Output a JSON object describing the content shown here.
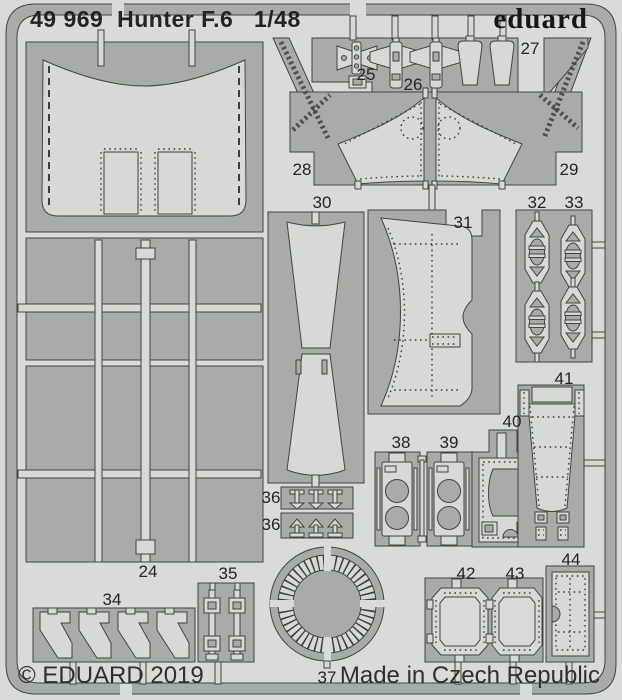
{
  "header": {
    "title": "49 969  Hunter F.6   1/48",
    "brand": "eduard"
  },
  "footer": {
    "copyright": "© EDUARD 2019",
    "made_in": "Made in Czech Republic"
  },
  "colors": {
    "bg": "#d9dbd8",
    "web": "#a8aca9",
    "part": "#d7d9d6",
    "outline": "#41443f",
    "text": "#222422"
  },
  "fret": {
    "part_labels": [
      {
        "id": "24",
        "text": "24"
      },
      {
        "id": "25",
        "text": "25"
      },
      {
        "id": "26",
        "text": "26"
      },
      {
        "id": "27",
        "text": "27"
      },
      {
        "id": "28",
        "text": "28"
      },
      {
        "id": "29",
        "text": "29"
      },
      {
        "id": "30",
        "text": "30"
      },
      {
        "id": "31",
        "text": "31"
      },
      {
        "id": "32",
        "text": "32"
      },
      {
        "id": "33",
        "text": "33"
      },
      {
        "id": "34",
        "text": "34"
      },
      {
        "id": "35",
        "text": "35"
      },
      {
        "id": "36a",
        "text": "36"
      },
      {
        "id": "36b",
        "text": "36"
      },
      {
        "id": "37",
        "text": "37"
      },
      {
        "id": "38",
        "text": "38"
      },
      {
        "id": "39",
        "text": "39"
      },
      {
        "id": "40",
        "text": "40"
      },
      {
        "id": "41",
        "text": "41"
      },
      {
        "id": "42",
        "text": "42"
      },
      {
        "id": "43",
        "text": "43"
      },
      {
        "id": "44",
        "text": "44"
      }
    ]
  }
}
